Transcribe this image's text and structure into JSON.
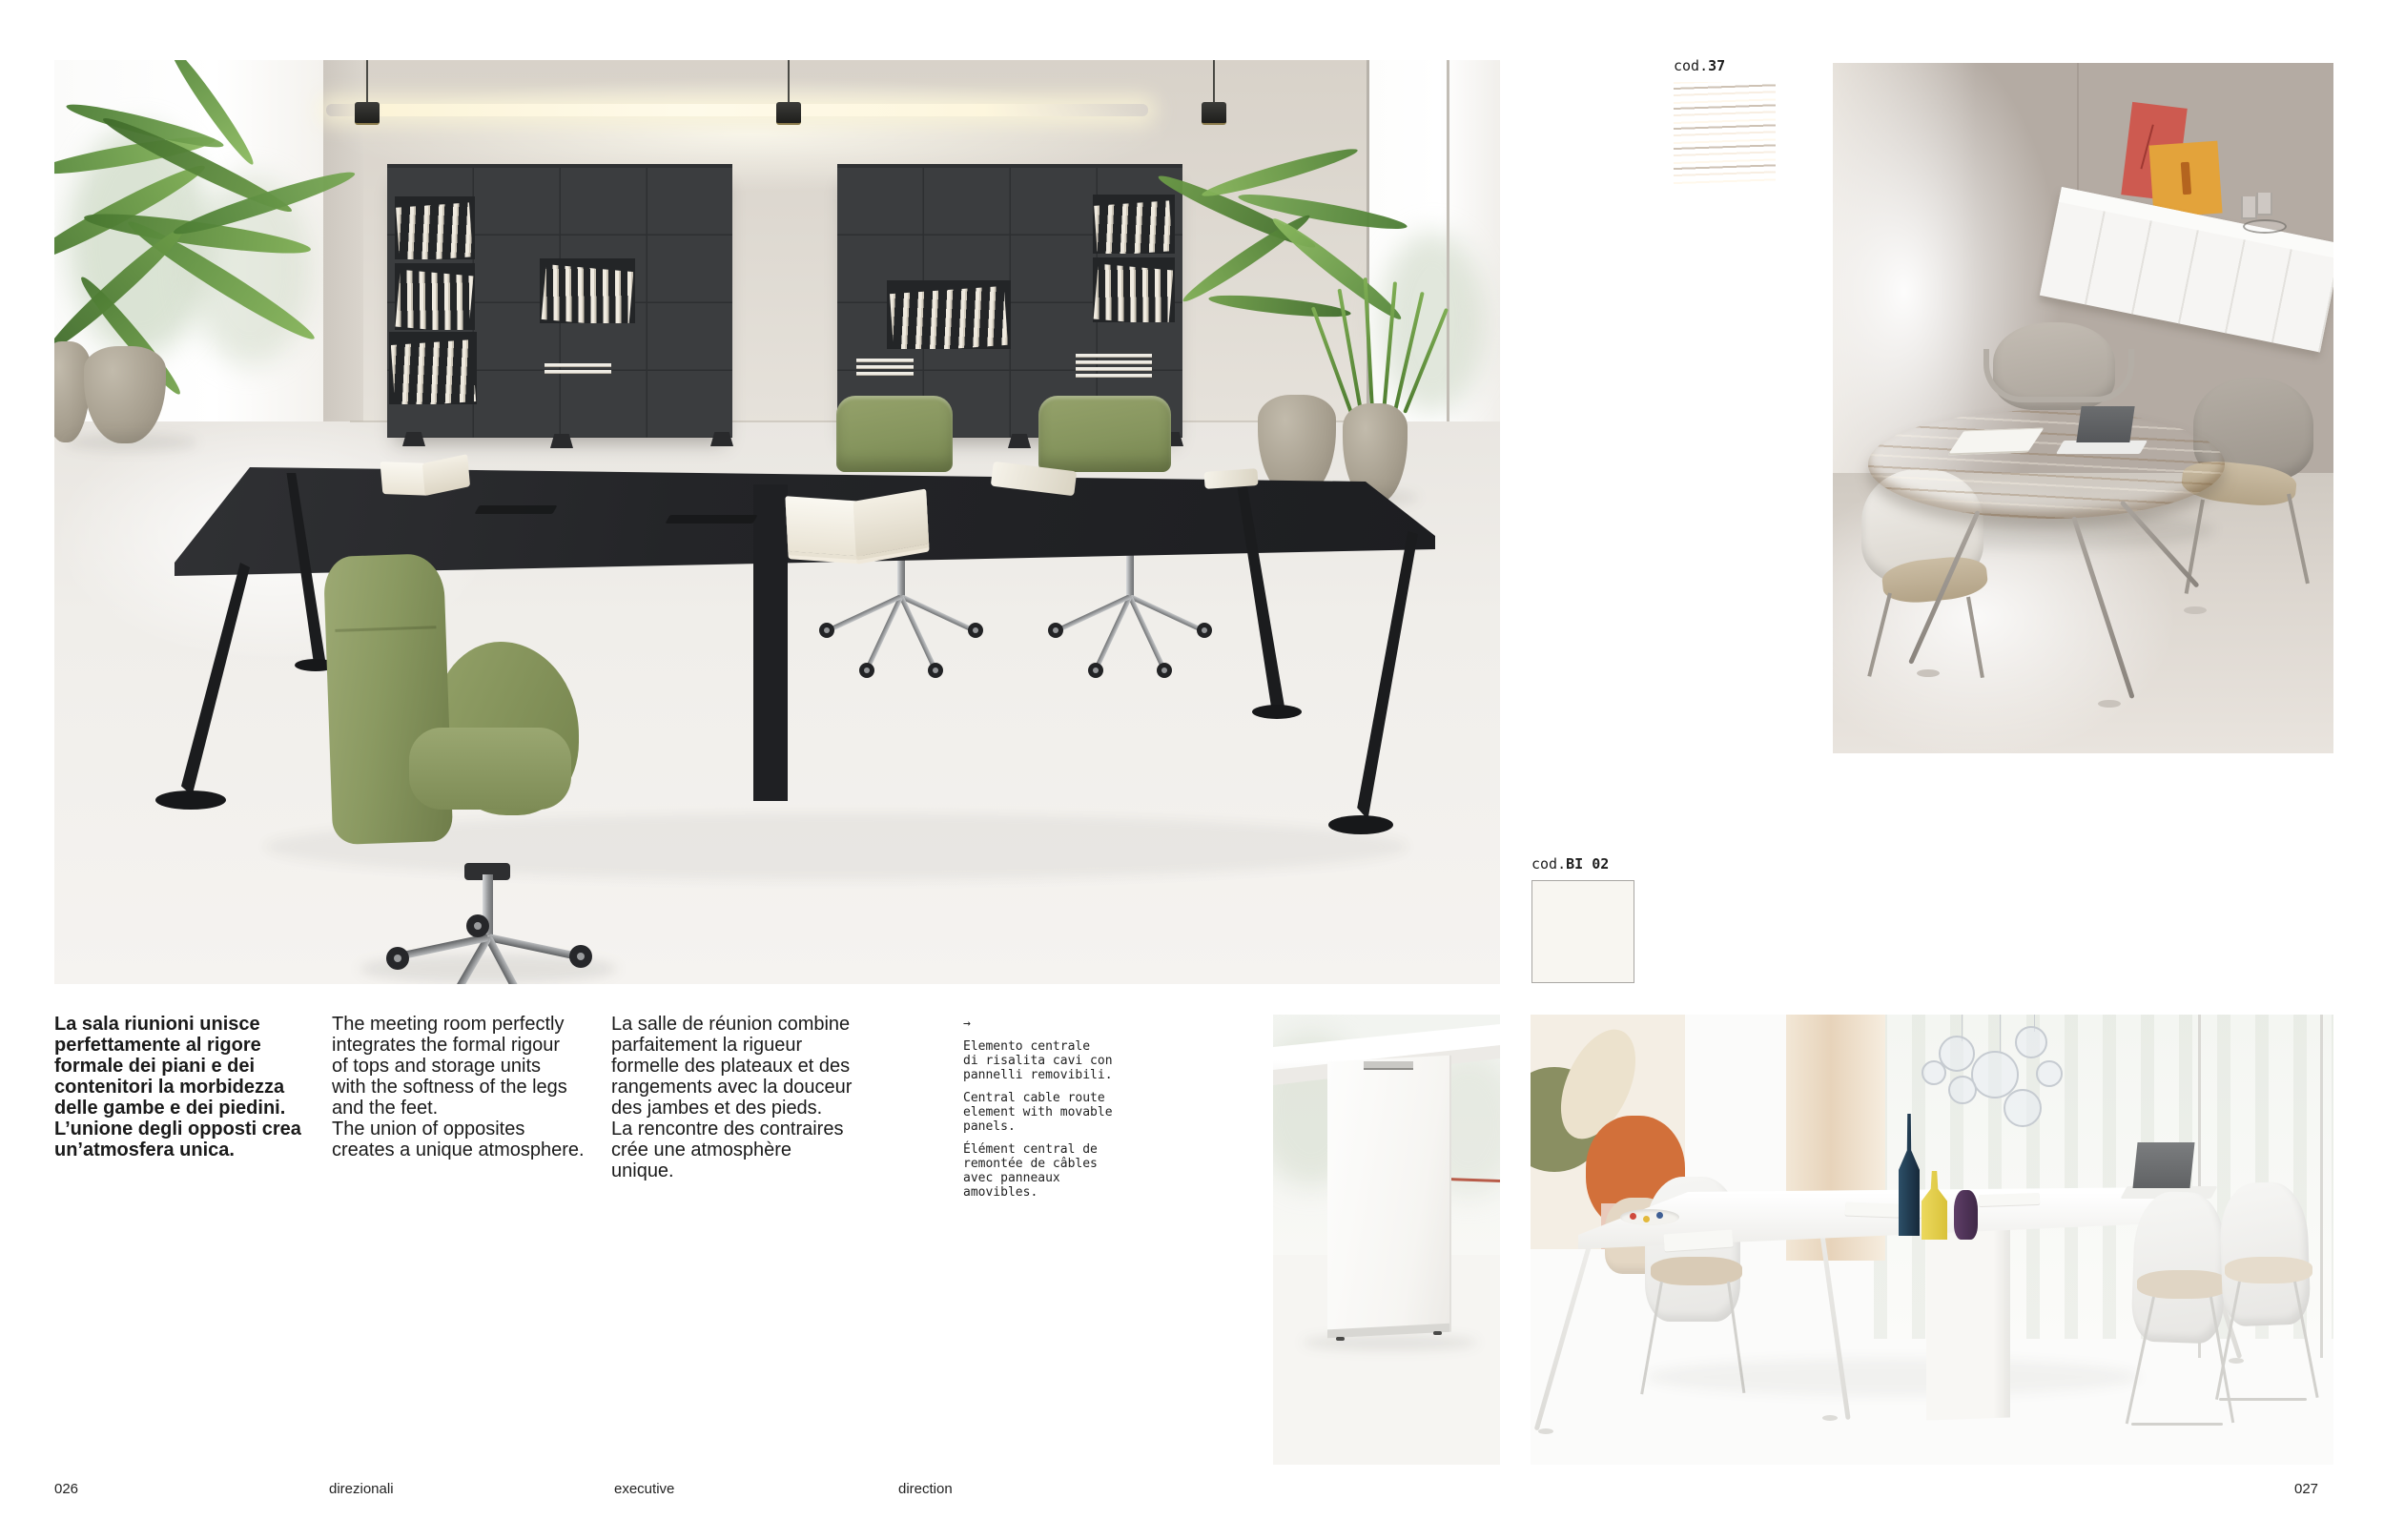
{
  "intro": {
    "italian": "La sala riunioni unisce\nperfettamente al rigore\nformale dei piani e dei\ncontenitori la morbidezza\ndelle gambe e dei piedini.\nL’unione degli opposti crea\nun’atmosfera unica.",
    "english": "The meeting room perfectly\nintegrates the formal rigour\nof tops and storage units\nwith the softness of the legs\nand the feet.\nThe union of opposites\ncreates a unique atmosphere.",
    "french": "La salle de réunion combine\nparfaitement la rigueur\nformelle des plateaux et des\nrangements avec la douceur\ndes jambes et des pieds.\nLa rencontre des contraires\ncrée une atmosphère\nunique."
  },
  "tech_note": {
    "arrow": "→",
    "italian": "Elemento centrale\ndi risalita cavi con\npannelli removibili.",
    "english": "Central cable route\nelement with movable\npanels.",
    "french": "Élément central de\nremontée de câbles\navec panneaux\namovibles."
  },
  "swatches": {
    "wood": {
      "prefix": "cod.",
      "code": "37",
      "color": "#b58a58"
    },
    "white": {
      "prefix": "cod.",
      "code": "BI 02",
      "color": "#f8f6f1"
    }
  },
  "footer": {
    "page_left": "026",
    "page_right": "027",
    "labels": [
      "direzionali",
      "executive",
      "direction"
    ]
  },
  "colors": {
    "chair_green": "#8a9961",
    "table_black": "#26272a",
    "cabinet_grey": "#3b3d3f",
    "art_red": "#cd5a50",
    "art_orange": "#e3a33b",
    "wall_taupe": "#b4aba3"
  }
}
